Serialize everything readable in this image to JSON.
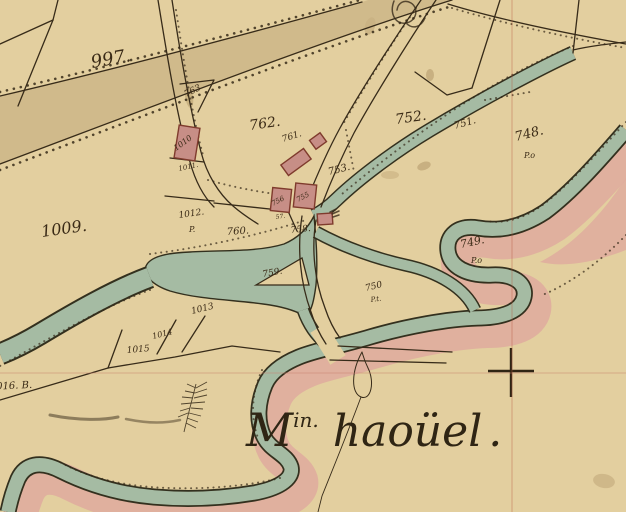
{
  "map": {
    "type": "historical-cadastral-map",
    "annotation": {
      "abbr": "M",
      "sup": "in.",
      "name": "haoüel",
      "period": "."
    },
    "labels": [
      {
        "text": "997.",
        "x": 92,
        "y": 68,
        "size": 18,
        "rot": -10
      },
      {
        "text": "763",
        "x": 186,
        "y": 97,
        "size": 9,
        "rot": -26
      },
      {
        "text": "762.",
        "x": 250,
        "y": 130,
        "size": 14,
        "rot": -8
      },
      {
        "text": "761.",
        "x": 283,
        "y": 142,
        "size": 9,
        "rot": -18
      },
      {
        "text": "753.",
        "x": 329,
        "y": 175,
        "size": 10,
        "rot": -14
      },
      {
        "text": "752.",
        "x": 396,
        "y": 124,
        "size": 14,
        "rot": -8
      },
      {
        "text": "751.",
        "x": 455,
        "y": 129,
        "size": 10,
        "rot": -16
      },
      {
        "text": "748.",
        "x": 516,
        "y": 141,
        "size": 13,
        "rot": -14
      },
      {
        "text": "P.o",
        "x": 524,
        "y": 158,
        "size": 8,
        "rot": 0
      },
      {
        "text": "749.",
        "x": 461,
        "y": 248,
        "size": 11,
        "rot": -12
      },
      {
        "text": "P.o",
        "x": 471,
        "y": 263,
        "size": 8,
        "rot": 0
      },
      {
        "text": "750",
        "x": 366,
        "y": 291,
        "size": 9,
        "rot": -14
      },
      {
        "text": "P.t.",
        "x": 371,
        "y": 302,
        "size": 7,
        "rot": -8
      },
      {
        "text": "759.",
        "x": 263,
        "y": 277,
        "size": 9,
        "rot": -10
      },
      {
        "text": "760.",
        "x": 227,
        "y": 235,
        "size": 10,
        "rot": -4
      },
      {
        "text": "758.",
        "x": 291,
        "y": 233,
        "size": 9,
        "rot": -6
      },
      {
        "text": "756",
        "x": 273,
        "y": 206,
        "size": 7,
        "rot": -28
      },
      {
        "text": "755",
        "x": 298,
        "y": 202,
        "size": 7,
        "rot": -28
      },
      {
        "text": "57.",
        "x": 276,
        "y": 219,
        "size": 6,
        "rot": -8
      },
      {
        "text": "1009.",
        "x": 42,
        "y": 237,
        "size": 16,
        "rot": -8
      },
      {
        "text": "1010",
        "x": 176,
        "y": 151,
        "size": 8,
        "rot": -36
      },
      {
        "text": "1011.",
        "x": 179,
        "y": 171,
        "size": 7,
        "rot": -12
      },
      {
        "text": "1012.",
        "x": 179,
        "y": 218,
        "size": 9,
        "rot": -8
      },
      {
        "text": "P.",
        "x": 189,
        "y": 232,
        "size": 8,
        "rot": 0
      },
      {
        "text": "1013",
        "x": 192,
        "y": 314,
        "size": 9,
        "rot": -14
      },
      {
        "text": "1014",
        "x": 153,
        "y": 339,
        "size": 8,
        "rot": -14
      },
      {
        "text": "1015",
        "x": 127,
        "y": 353,
        "size": 9,
        "rot": -5
      },
      {
        "text": "1016. B.",
        "x": -10,
        "y": 390,
        "size": 10,
        "rot": -3
      }
    ],
    "colors": {
      "paper": "#e3cf9f",
      "shade_band": "#c9b183",
      "water": "#a5bba3",
      "water_edge": "#33301e",
      "bank_pink": "#dfac9d",
      "building": "#c78e86",
      "building_outline": "#7f3b2d",
      "line_ink": "#372b19",
      "label_ink": "#3a2a16",
      "annotation_ink": "#2f2514",
      "fold_line_h": "#c9826f",
      "fold_line_v": "#b5543d"
    },
    "symbols": {
      "survey_cross": "+",
      "plant_sketch": "fern",
      "ink_smudge": true
    }
  }
}
